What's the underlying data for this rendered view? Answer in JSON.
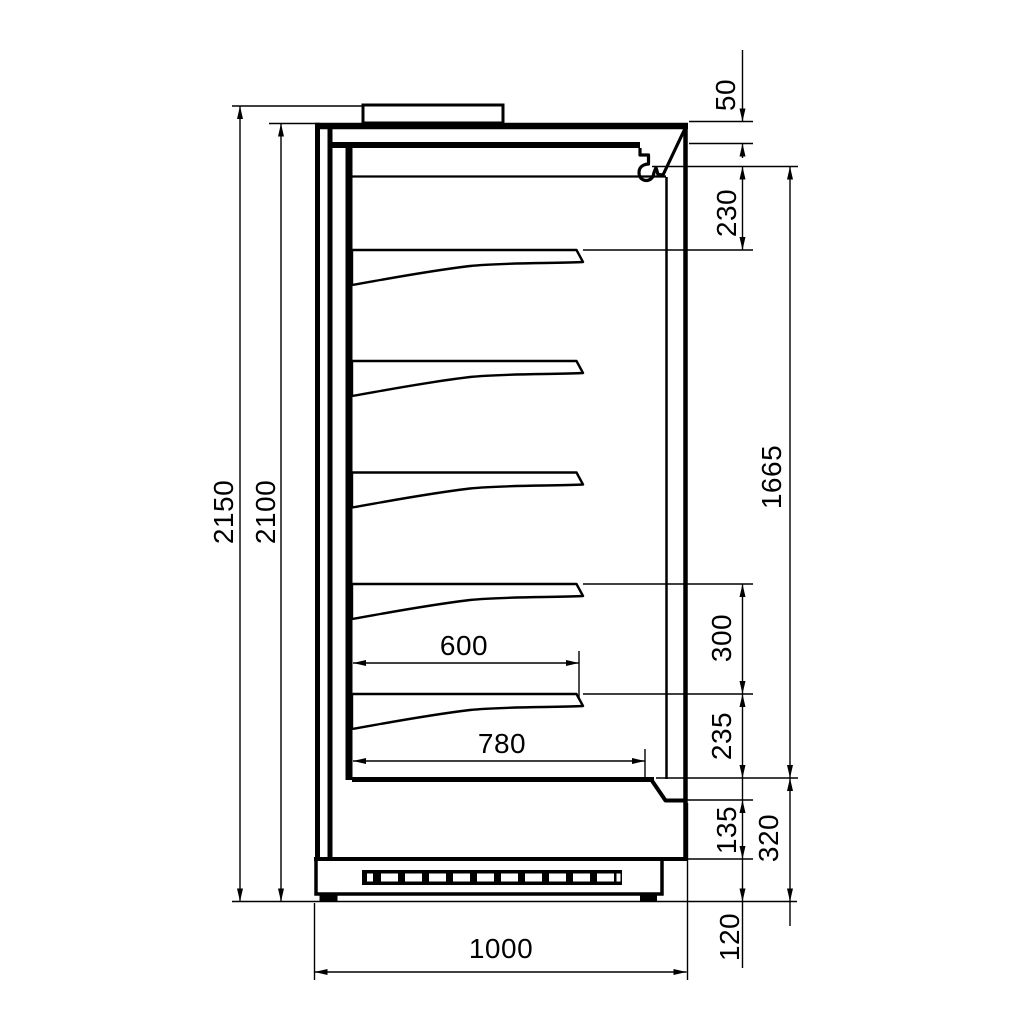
{
  "dimensions": {
    "overall_height": "2150",
    "cabinet_height": "2100",
    "canopy_thickness": "50",
    "canopy_to_top_shelf": "230",
    "display_opening_height": "1665",
    "shelf_spacing": "300",
    "bottom_shelf_to_deck": "235",
    "front_panel_height": "135",
    "base_section_height": "320",
    "plinth_clearance": "120",
    "shelf_depth": "600",
    "deck_depth": "780",
    "overall_depth": "1000"
  }
}
